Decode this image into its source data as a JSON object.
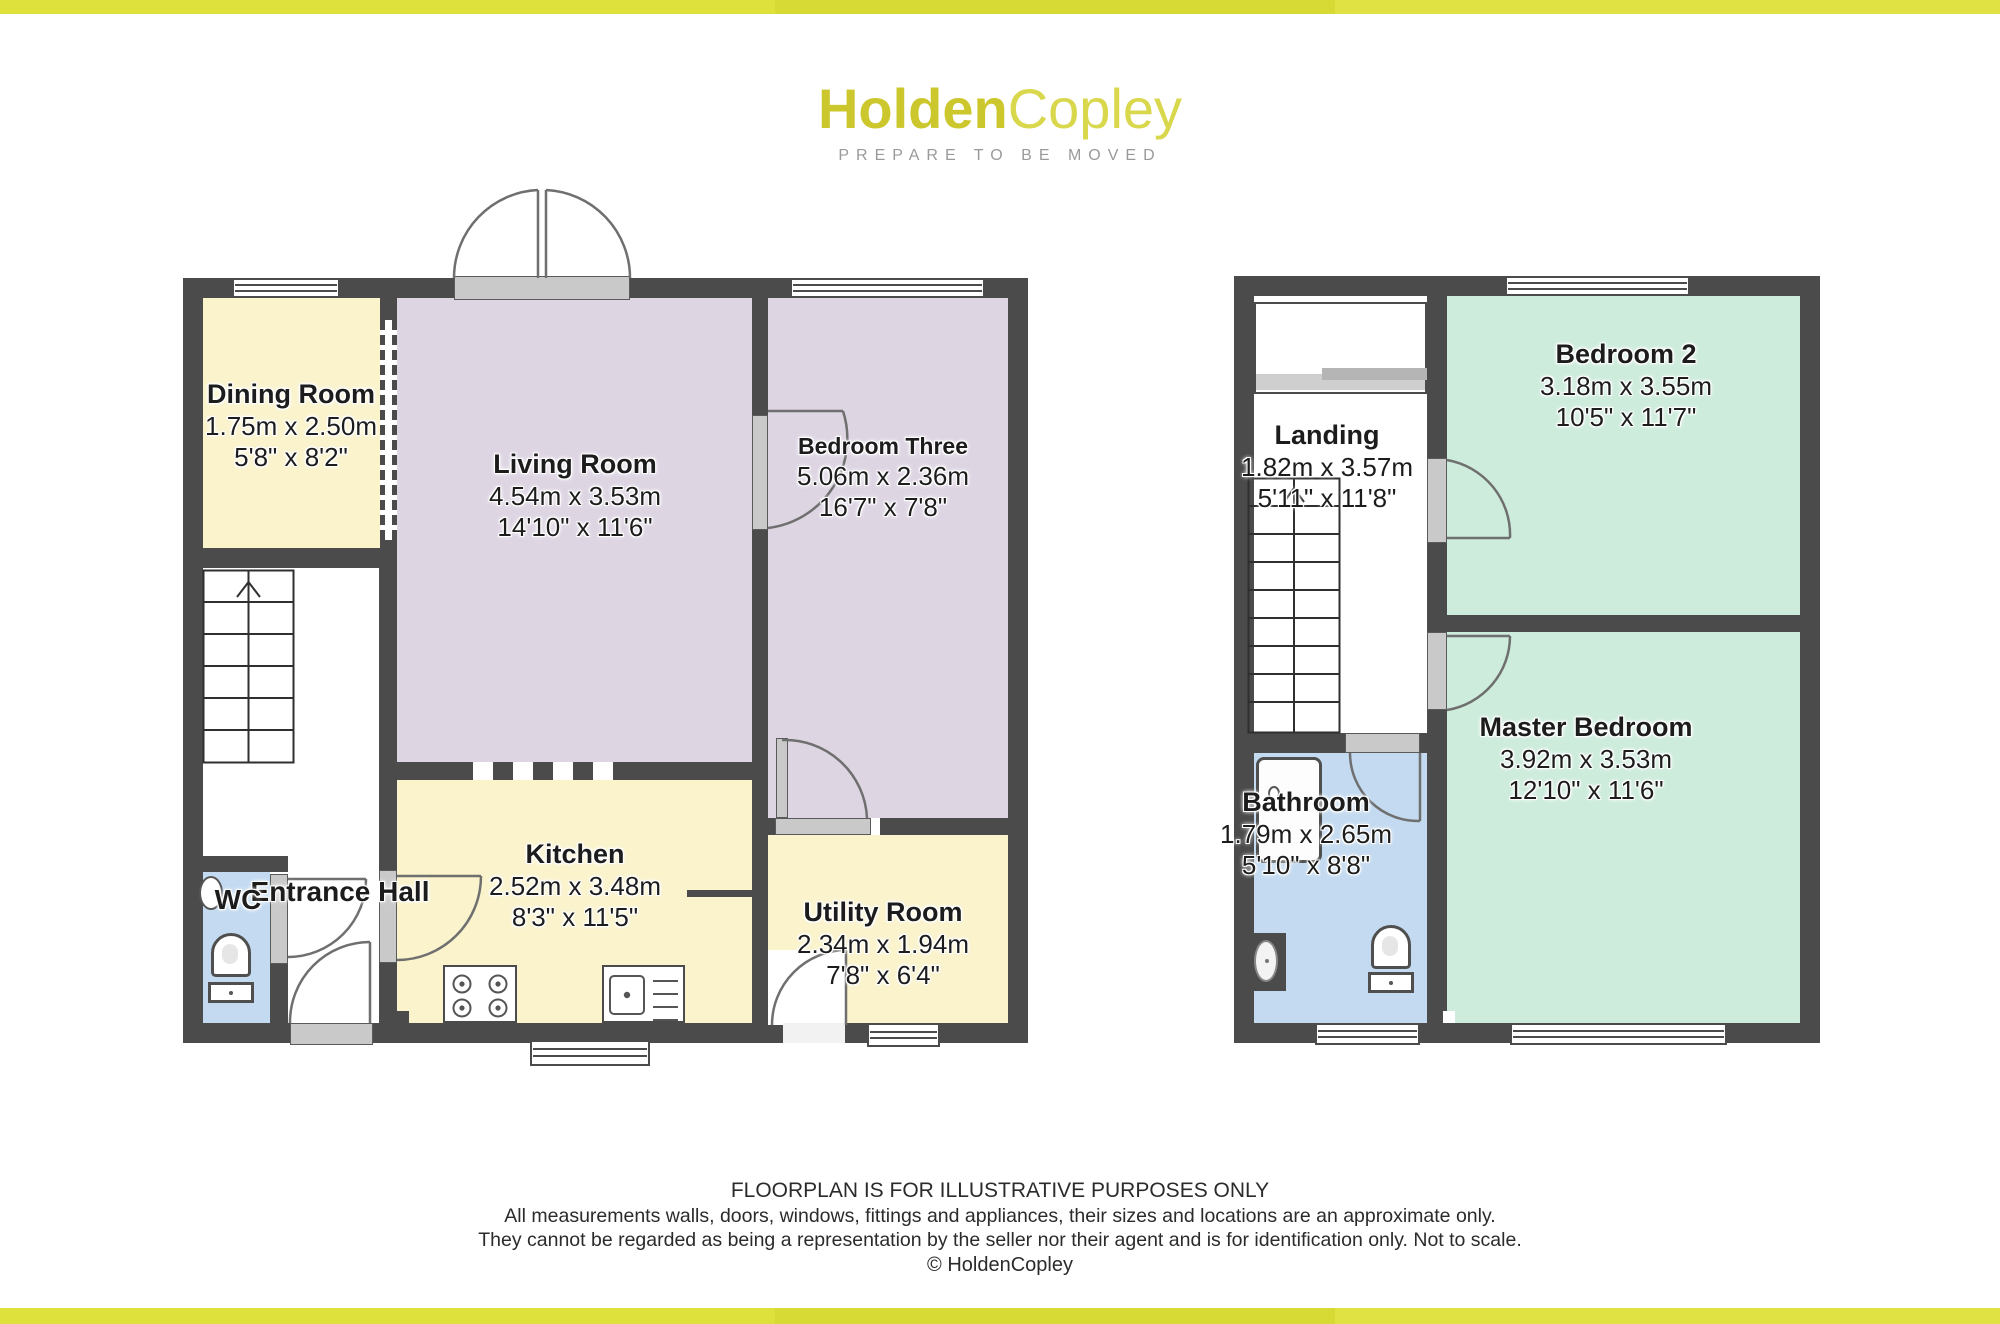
{
  "brand": {
    "logo_part1": "Holden",
    "logo_part2": "Copley",
    "tagline": "PREPARE TO BE MOVED",
    "brand_yellow": "#d5d335",
    "bar_yellow": "#dfe13c"
  },
  "colors": {
    "wall": "#4b4b4b",
    "room_yellow": "#faf3cc",
    "room_lavender": "#ded5e3",
    "room_green": "#cdecdc",
    "room_blue": "#c3daf0"
  },
  "ground_floor": {
    "dining_room": {
      "name": "Dining Room",
      "metric": "1.75m x 2.50m",
      "imperial": "5'8\" x 8'2\""
    },
    "living_room": {
      "name": "Living Room",
      "metric": "4.54m x 3.53m",
      "imperial": "14'10\" x 11'6\""
    },
    "bedroom_three": {
      "name": "Bedroom Three",
      "metric": "5.06m x 2.36m",
      "imperial": "16'7\" x 7'8\""
    },
    "kitchen": {
      "name": "Kitchen",
      "metric": "2.52m x 3.48m",
      "imperial": "8'3\" x 11'5\""
    },
    "utility_room": {
      "name": "Utility Room",
      "metric": "2.34m x 1.94m",
      "imperial": "7'8\" x 6'4\""
    },
    "entrance_hall": {
      "name": "Entrance Hall"
    },
    "wc": {
      "name": "WC"
    }
  },
  "first_floor": {
    "landing": {
      "name": "Landing",
      "metric": "1.82m x 3.57m",
      "imperial": "5'11\" x 11'8\""
    },
    "bedroom_2": {
      "name": "Bedroom 2",
      "metric": "3.18m x 3.55m",
      "imperial": "10'5\" x 11'7\""
    },
    "master_bedroom": {
      "name": "Master Bedroom",
      "metric": "3.92m x 3.53m",
      "imperial": "12'10\" x 11'6\""
    },
    "bathroom": {
      "name": "Bathroom",
      "metric": "1.79m x 2.65m",
      "imperial": "5'10\" x 8'8\""
    }
  },
  "footer": {
    "line1": "FLOORPLAN IS FOR ILLUSTRATIVE PURPOSES ONLY",
    "line2": "All measurements walls, doors, windows, fittings and appliances, their sizes and locations are an approximate only.",
    "line3": "They cannot be regarded as being a representation by the seller nor their agent and is for identification only. Not to scale.",
    "line4": "© HoldenCopley"
  }
}
